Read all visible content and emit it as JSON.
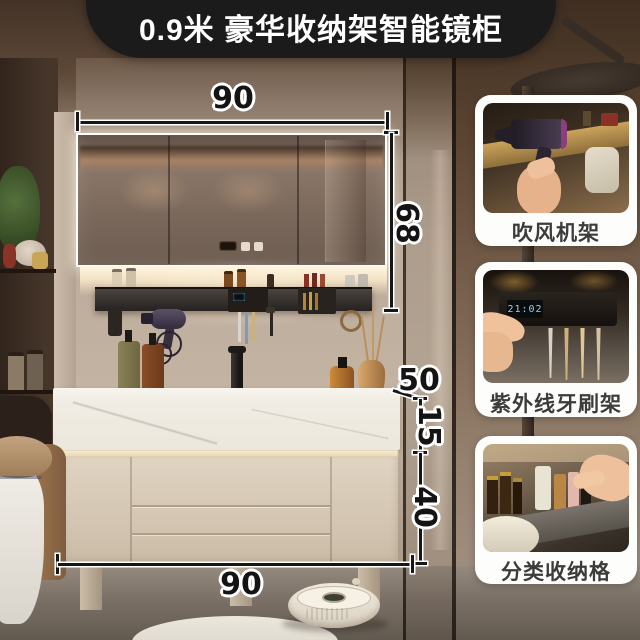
{
  "banner": {
    "title": "0.9米 豪华收纳架智能镜柜"
  },
  "dimensions": {
    "top_width": "90",
    "mirror_height": "68",
    "counter_depth": "50",
    "counter_thickness": "15",
    "cabinet_height": "40",
    "bottom_width": "90"
  },
  "feature_cards": [
    {
      "label": "吹风机架"
    },
    {
      "label": "紫外线牙刷架",
      "clock_display": "21:02"
    },
    {
      "label": "分类收纳格"
    }
  ],
  "colors": {
    "banner_bg": "#1b1b1b",
    "dimension_ink": "#141414",
    "card_bg": "#fdfdfb",
    "wall": "#b5a394",
    "cabinet": "#d8cbb8",
    "countertop": "#f3efe8"
  }
}
